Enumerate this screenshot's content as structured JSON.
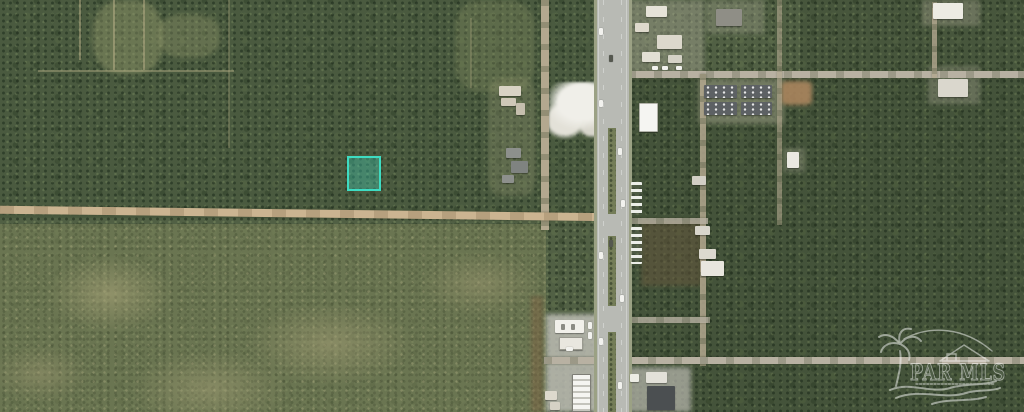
{
  "watermark": {
    "text": "PAR MLS",
    "color": "#ffffff",
    "opacity": 0.52,
    "icons": [
      "palm-tree-icon",
      "beach-house-icon",
      "waves-icon"
    ]
  },
  "parcel_highlight": {
    "border_color": "#3edcc2",
    "fill_color": "rgba(62,216,188,0.35)"
  },
  "map_palette": {
    "forest": "#516044",
    "scrub": "#7d8460",
    "dirt_road": "#cbb491",
    "paved_road": "#b8bab4",
    "median_grass": "#747d58",
    "sand_clearing": "#e9e7df",
    "bare_dirt": "#aa855e"
  },
  "map_features": {
    "type": "satellite-aerial",
    "highway": "divided-highway-vertical",
    "dirt_road": "horizontal-dirt-road-west",
    "highlighted_parcel": "teal-square-parcel"
  }
}
